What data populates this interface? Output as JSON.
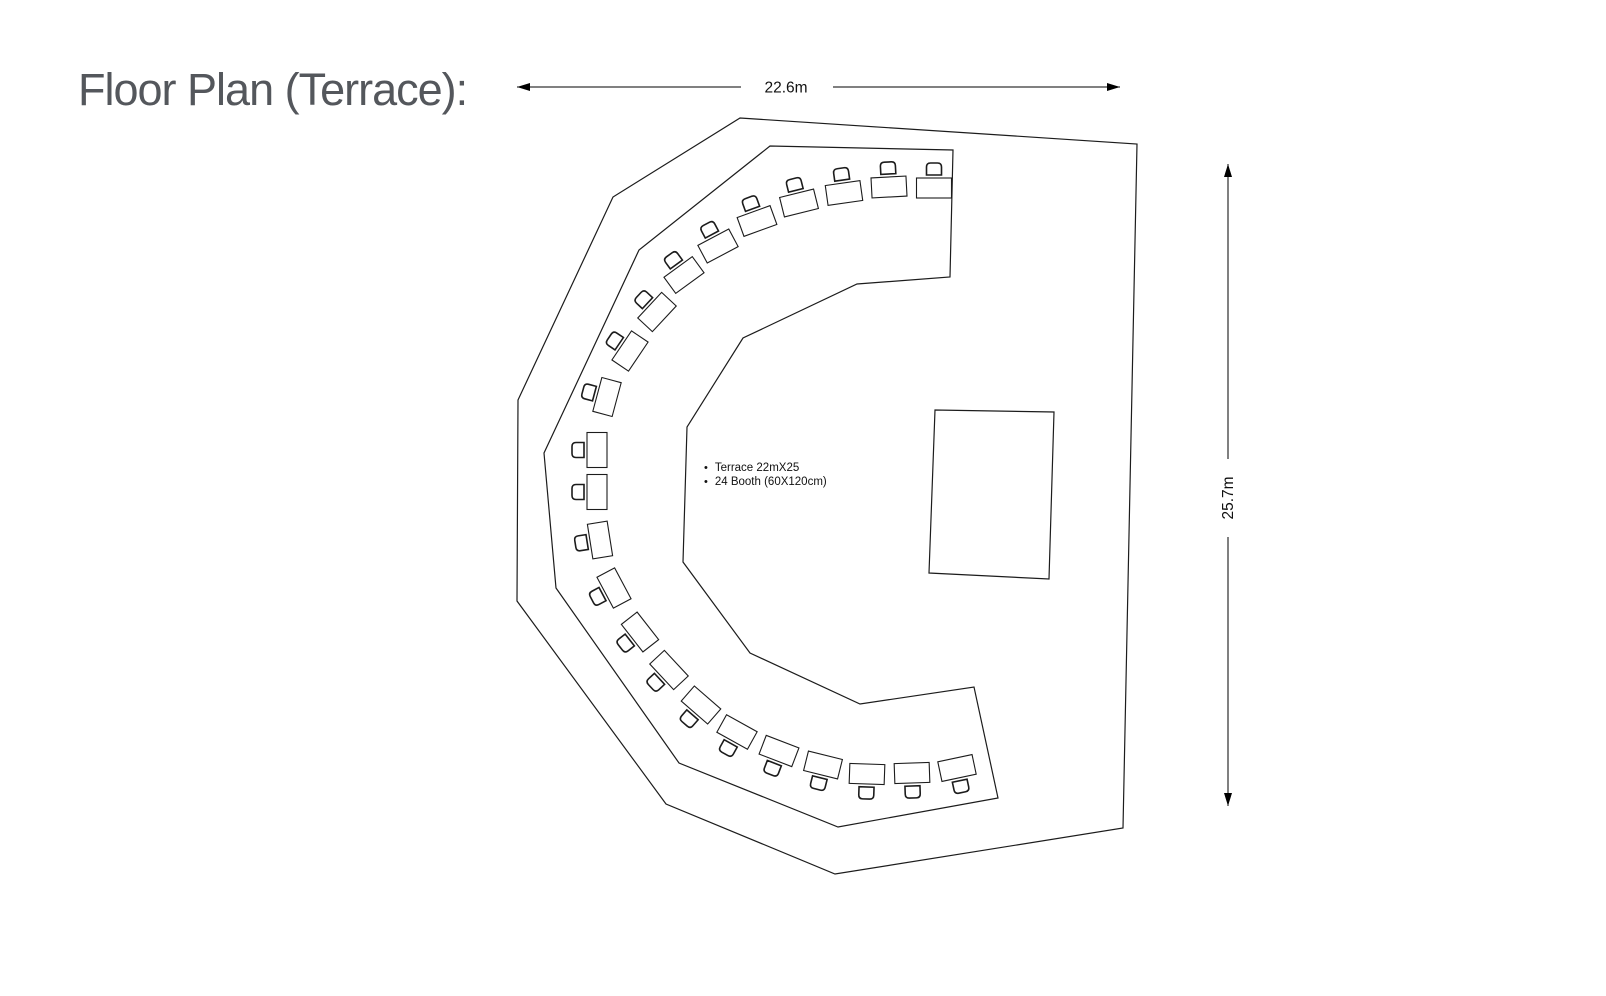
{
  "title": "Floor Plan (Terrace):",
  "notes": [
    "Terrace 22mX25",
    "24 Booth (60X120cm)"
  ],
  "dimensions": {
    "width_label": "22.6m",
    "height_label": "25.7m"
  },
  "colors": {
    "line": "#1c1c1c",
    "dimension": "#000000",
    "title_text": "#54575c",
    "background": "#ffffff"
  },
  "floor_plan": {
    "terrace_polygon": "740,118 1137,144 1123,828 835,874 666,804 517,601 518,400 613,197",
    "booth_zone_polygon": "953,150 950,277 857,284 743,338 687,427 683,562 750,653 860,704 974,687 998,798 838,827 679,763 556,588 544,453 639,250 770,146",
    "stage_polygon": "935,410 1054,412 1049,579 929,573",
    "booth_size": {
      "w": 35,
      "h": 20
    },
    "chair_path": "M -7.5 -13 L -7.5 -21 Q -7.5 -25 -3.5 -25 L 3.5 -25 Q 7.5 -25 7.5 -21 L 7.5 -13 Z",
    "booths": [
      {
        "x": 934,
        "y": 188,
        "a": 0
      },
      {
        "x": 889,
        "y": 187,
        "a": -3
      },
      {
        "x": 844,
        "y": 193,
        "a": -8
      },
      {
        "x": 799,
        "y": 203,
        "a": -14
      },
      {
        "x": 757,
        "y": 221,
        "a": -20
      },
      {
        "x": 718,
        "y": 246,
        "a": -28
      },
      {
        "x": 684,
        "y": 275,
        "a": -36
      },
      {
        "x": 657,
        "y": 312,
        "a": -47
      },
      {
        "x": 630,
        "y": 351,
        "a": -56
      },
      {
        "x": 607,
        "y": 397,
        "a": -75
      },
      {
        "x": 597,
        "y": 450,
        "a": -90
      },
      {
        "x": 597,
        "y": 492,
        "a": -90
      },
      {
        "x": 600,
        "y": 540,
        "a": -99
      },
      {
        "x": 614,
        "y": 588,
        "a": -118
      },
      {
        "x": 640,
        "y": 632,
        "a": -128
      },
      {
        "x": 669,
        "y": 670,
        "a": -133
      },
      {
        "x": 701,
        "y": 705,
        "a": -139
      },
      {
        "x": 737,
        "y": 732,
        "a": -151
      },
      {
        "x": 779,
        "y": 751,
        "a": -159
      },
      {
        "x": 823,
        "y": 765,
        "a": -166
      },
      {
        "x": 867,
        "y": 774,
        "a": -178
      },
      {
        "x": 912,
        "y": 773,
        "a": -182
      },
      {
        "x": 957,
        "y": 768,
        "a": -192
      }
    ]
  }
}
